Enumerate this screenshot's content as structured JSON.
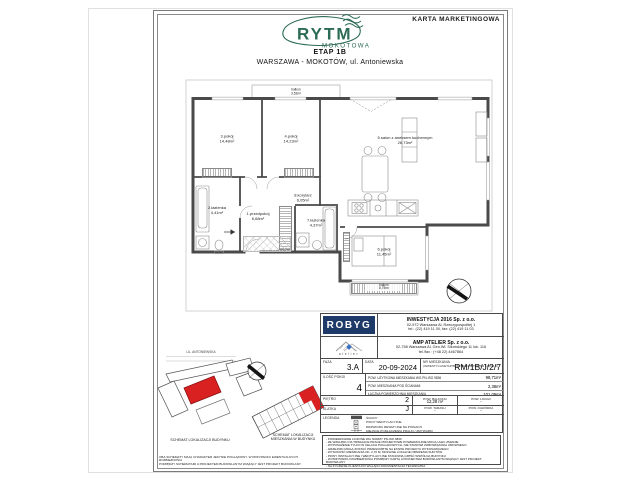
{
  "header": {
    "doc_type": "KARTA MARKETINGOWA",
    "logo": {
      "brand": "RYTM",
      "sub": "MOKOTOWA"
    },
    "stage": "ETAP 1B",
    "location": "WARSZAWA - MOKOTÓW, ul. Antoniewska"
  },
  "plan": {
    "rooms": [
      {
        "name": "3.pokój",
        "area": "14,48m²"
      },
      {
        "name": "4.pokój",
        "area": "14,23m²"
      },
      {
        "name": "5.salon z aneksem kuchennym",
        "area": "26,73m²"
      },
      {
        "name": "6.pokój",
        "area": "11,45m²"
      },
      {
        "name": "1.przedpokój",
        "area": "6,68m²"
      },
      {
        "name": "2.łazienka",
        "area": "4,41m²"
      },
      {
        "name": "7.łazienka",
        "area": "4,37m²"
      },
      {
        "name": "8.korytarz",
        "area": "6,05m²"
      }
    ],
    "balcony_top": {
      "name": "balkon",
      "area": "3,53m²"
    },
    "balcony_bottom": {
      "name": "balkon",
      "area": "8,75m²"
    }
  },
  "site": {
    "street": "UL. ANTONIEWSKA",
    "caption_building": "SCHEMAT LOKALIZACJI BUDYNKU",
    "caption_unit_1": "SCHEMAT LOKALIZACJI",
    "caption_unit_2": "MIESZKANIA W BUDYNKU",
    "note_1": "OBA SCHEMATY MAJĄ CHARAKTER JEDYNIE POGLĄDOWY. W PRZYPADKU EWENTUALNYCH ROZBIEŻNOŚCI",
    "note_2": "POMIĘDZY SCHEMATAMI A PROJEKTEM BUDOWLANYM WIĄŻĄCY JEST PROJEKT BUDOWLANY."
  },
  "companies": {
    "developer": {
      "logo": "ROBYG",
      "name": "INWESTYCJA 2016 Sp. z o.o.",
      "address": "02-972 Warszawa Al. Rzeczypospolitej 1",
      "phone": "tel.: (22) 419 11 00, fax: (22) 419 11 03"
    },
    "studio": {
      "logo_text": "atelier",
      "name": "AMP ATELIER Sp. z o.o.",
      "address": "02-758 Warszawa Al. Gen.Wł. Sikorskiego 11 lok. 116",
      "phone": "tel./fax : (+48 22) 4467864"
    }
  },
  "details": {
    "faza_label": "FAZA",
    "faza": "3.A",
    "data_label": "DATA",
    "data": "20-09-2024",
    "nr_label": "NR MIESZKANIA",
    "nr_sublabel": "(INWESTYCJA/ETAP/BUDYNEK/PIĘTRO/NR LOKALU)",
    "nr": "RM/1B/J/2/7",
    "rooms_label": "ILOŚĆ POKOI",
    "rooms": "4",
    "area_rows": [
      {
        "label": "POW. UŻYTKOWA MIESZKANIA WG PN-ISO 9836",
        "value": "98,71m²"
      },
      {
        "label": "POW. MIESZKANIA POD ŚCIANAMI",
        "value": "2,38m²"
      },
      {
        "label": "ŁĄCZNA POWIERZCHNIA MIESZKANIA",
        "value": "101,09m²"
      }
    ],
    "pietro_label": "PIĘTRO",
    "pietro": "2",
    "balkon_label": "POW. BALKONU",
    "balkon": "12,28 m²",
    "loggia_label": "POW. LOGGII",
    "loggia": "-",
    "klatka_label": "KLATKA",
    "klatka": "J",
    "taras_label": "POW. TARASU",
    "taras": "-",
    "ogrodek_label": "POW. OGRÓDKA",
    "ogrodek": "-"
  },
  "legend": {
    "label": "LEGENDA",
    "items": [
      "ŚCIANY",
      "PIONY WENTYLACYJNE",
      "DRZWICZKI REWIZYJNE NA PIONACH",
      "MIEJSCE PODŁĄCZENIA PRALKI / ZMYWARKI"
    ]
  },
  "notes": [
    "POWIERZCHNIE LICZONE WG NORMY PN-ISO 9836",
    "ZE WZGLĘDU NA TRWAJĄCE PRACE PROJEKTOWE POWIERZCHNIE MOGĄ ULEC ZMIANIE",
    "WYPOSAŻENIE TYLKO W CELACH POGLĄDOWYCH, NIE STANOWI ZOBOWIĄZANIA UMOWNEGO",
    "GRZEJNIKI MOGĄ ZOSTAĆ PRZESUNIĘTE NA ETAPIE PROJEKTU WYKONAWCZEGO",
    "WYSOKOŚĆ MIESZKANIA OK. 2,70 M; MOŻLIWE LOKALNE OBNIŻENIA SUFITÓW",
    "PIONY INSTALACYJNE I WENTYLACYJNE STANOWIĄ CZĘŚĆ WSPÓLNĄ BUDYNKU",
    "W PRZYPADKU ROZBIEŻNOŚCI POMIĘDZY KARTĄ A PROJEKTEM BUDOWLANYM WIĄŻĄCY JEST PROJEKT BUDOWLANY",
    "NA ŻYCZENIE KLIENTA DO WGLĄDU DOKUMENTACJA TECHNICZNA"
  ],
  "colors": {
    "accent_green": "#2c6b54",
    "navy": "#1e3a68",
    "highlight_red": "#d92121"
  }
}
